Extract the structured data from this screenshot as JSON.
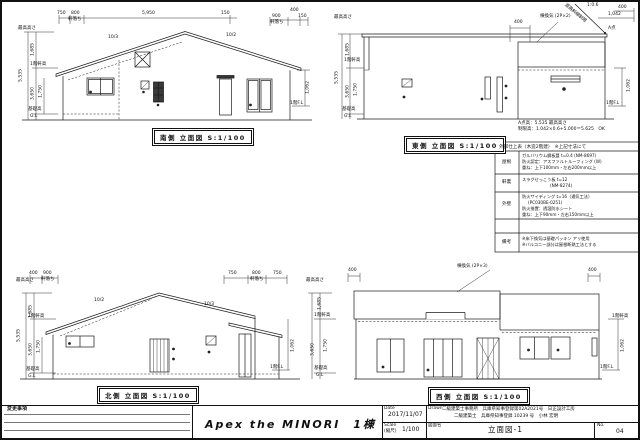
{
  "south": {
    "caption": "南側 立面図 S:1/100",
    "dim_max": "最高高さ",
    "dim_1685": "1,685",
    "dim_eave": "1階軒高",
    "dim_total": "5,535",
    "dim_3650": "3,650",
    "dim_1750": "1,750",
    "dim_found": "基礎高",
    "dim_gl": "G.L",
    "top_750": "750",
    "top_800": "800",
    "top_nokiochi": "軒落ち",
    "top_5950": "5,950",
    "top_150": "150",
    "top_400": "400",
    "top_900": "900",
    "top_nokiochi2": "軒落ち",
    "top_150b": "150",
    "slope_left": "10/3",
    "slope_right": "10/2",
    "right_1062": "1,062",
    "right_fl": "1階F.L"
  },
  "east": {
    "caption": "東側 立面図 S:1/100",
    "dim_max": "最高高さ",
    "dim_1685": "1,685",
    "dim_eave": "1階軒高",
    "dim_total": "5,535",
    "dim_3650": "3,650",
    "dim_1750": "1,750",
    "dim_found": "基礎高",
    "dim_gl": "G.L",
    "top_400": "400",
    "vent": "棟換気 (2P×2)",
    "road_line": "道路斜線制限",
    "road_ratio": "1:0.6",
    "dim_1042": "1,042",
    "dim_400b": "400",
    "a_point": "A点",
    "right_1062": "1,062",
    "right_fl": "1階F.L",
    "note1": "A点高：5,535 最高高さ",
    "note2": "制限高：1.042×0.6+5.000＝5.625　OK"
  },
  "north": {
    "caption": "北側 立面図 S:1/100",
    "dim_max": "最高高さ",
    "dim_1685": "1,685",
    "dim_eave": "1階軒高",
    "dim_total": "5,535",
    "dim_3650": "3,650",
    "dim_1750": "1,750",
    "dim_found": "基礎高",
    "dim_gl": "G.L",
    "top_400": "400",
    "top_900": "900",
    "top_nokiochi": "軒落ち",
    "top_750": "750",
    "top_800": "800",
    "top_nokiochi2": "軒落ち",
    "top_750b": "750",
    "slope_left": "10/2",
    "slope_right": "10/3",
    "right_1062": "1,062",
    "right_fl": "1階F.L"
  },
  "west": {
    "caption": "西側 立面図 S:1/100",
    "dim_max": "最高高さ",
    "dim_1685": "1,685",
    "dim_eave": "1階軒高",
    "dim_1750": "1,750",
    "dim_3650": "3,650",
    "dim_found": "基礎高",
    "dim_gl": "G.L",
    "top_400l": "400",
    "top_400r": "400",
    "vent": "棟換気 (2P×3)",
    "right_eave": "1階軒高",
    "right_1062": "1,062",
    "right_fl": "1階F.L"
  },
  "finish_table": {
    "header": "外部仕上表（木造2階建）　※上記寸法にて",
    "rows": [
      {
        "label": "屋根",
        "l1": "ガルバリウム鋼板葺 t=0.4 (NM-8697)",
        "l2": "防火認定：アスファルトルーフィング (W)",
        "l3": "重ね：上下100mm・左右200mm以上",
        "l4": ""
      },
      {
        "label": "軒裏",
        "l1": "スラグせっこう板 t=12",
        "l2": "(NM-8274)",
        "l3": "",
        "l4": ""
      },
      {
        "label": "外壁",
        "l1": "防火サイディング t=16（通気工法）",
        "l2": "(PC030BE-0251)",
        "l3": "防火措置：透湿防水シート",
        "l4": "重ね：上下90mm・左右150mm以上"
      },
      {
        "label": "",
        "l1": "",
        "l2": "",
        "l3": "",
        "l4": ""
      },
      {
        "label": "備考",
        "l1": "※床下換気は基礎パッキン アリ使用",
        "l2": "※バルコニー部分は屋根断熱工法とする",
        "l3": "",
        "l4": ""
      }
    ]
  },
  "title_block": {
    "change_label": "変更事項",
    "project_title": "Apex the MINORI　1棟",
    "date_label": "Date",
    "date_value": "2017/11/07",
    "drawn_label": "Drawn",
    "drawn_line1": "二級建築士事務所　兵庫県知事登録第02A2021号　日正設計工房",
    "drawn_line2": "二級建築士　兵庫県知事登録 10239 号　小林 宏明",
    "scale_label": "Scale",
    "scale_sub": "(縮尺)",
    "scale_value": "1/100",
    "name_label": "図面名",
    "name_value": "立面図-1",
    "no_label": "No.",
    "no_value": "04"
  }
}
